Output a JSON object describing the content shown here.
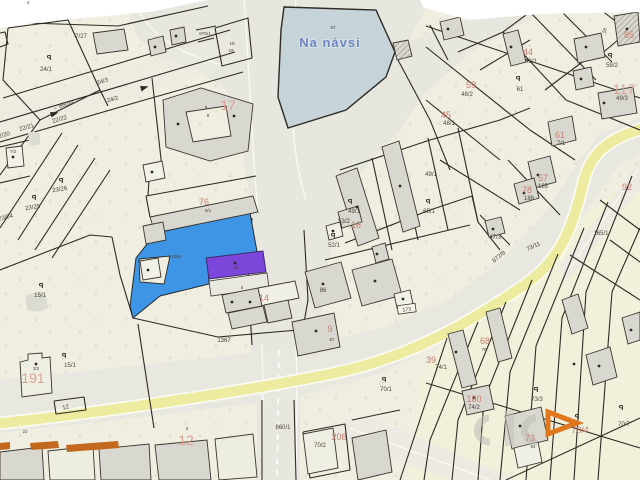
{
  "map": {
    "type": "cadastral-map",
    "pond": {
      "name": "Na návsi",
      "parcel": "67"
    },
    "highlight": {
      "selected_parcel_color": "#3e95e5",
      "selected_building_color": "#7b46d9",
      "selected_building_label": "60",
      "selected_area_ref": "1364"
    },
    "road": {
      "stripe_color": "#eceb9f",
      "plate_number": "173"
    },
    "watermark": {
      "arrow_color": "#e0761e"
    },
    "labels": [
      {
        "text": "Na návsi",
        "x": 330,
        "y": 47,
        "cls": "pond"
      },
      {
        "text": "67",
        "x": 333,
        "y": 29,
        "cls": "pt"
      },
      {
        "text": "875/1",
        "x": 205,
        "y": 35,
        "cls": "pt"
      },
      {
        "text": "18",
        "x": 232,
        "y": 45,
        "cls": "pt"
      },
      {
        "text": "19",
        "x": 231,
        "y": 52,
        "cls": "pt"
      },
      {
        "text": "7/27",
        "x": 81,
        "y": 38,
        "cls": "p"
      },
      {
        "text": "4",
        "x": 28,
        "y": 4,
        "cls": "pt"
      },
      {
        "text": "24/1",
        "x": 46,
        "y": 71,
        "cls": "p"
      },
      {
        "text": "24/3",
        "x": 103,
        "y": 83,
        "cls": "p",
        "rot": -18
      },
      {
        "text": "→ 860/4",
        "x": 63,
        "y": 107,
        "cls": "p",
        "rot": -17
      },
      {
        "text": "22/22",
        "x": 60,
        "y": 121,
        "cls": "p",
        "rot": -15
      },
      {
        "text": "22/21",
        "x": 27,
        "y": 129,
        "cls": "p",
        "rot": -15
      },
      {
        "text": "22/20",
        "x": 3,
        "y": 137,
        "cls": "p",
        "rot": -15
      },
      {
        "text": "24/2",
        "x": 113,
        "y": 101,
        "cls": "p",
        "rot": -15
      },
      {
        "text": "7/2",
        "x": 13,
        "y": 153,
        "cls": "pt"
      },
      {
        "text": "9",
        "x": 206,
        "y": 109,
        "cls": "pt"
      },
      {
        "text": "8",
        "x": 208,
        "y": 117,
        "cls": "pt"
      },
      {
        "text": "17",
        "x": 228,
        "y": 110,
        "cls": "hl"
      },
      {
        "text": "23/26",
        "x": 60,
        "y": 191,
        "cls": "p",
        "rot": -10
      },
      {
        "text": "23/25",
        "x": 33,
        "y": 209,
        "cls": "p",
        "rot": -10
      },
      {
        "text": "23/24",
        "x": 6,
        "y": 219,
        "cls": "p",
        "rot": -14
      },
      {
        "text": "15/1",
        "x": 40,
        "y": 297,
        "cls": "p"
      },
      {
        "text": "15/1",
        "x": 70,
        "y": 367,
        "cls": "p"
      },
      {
        "text": "3/2",
        "x": 36,
        "y": 370,
        "cls": "pt"
      },
      {
        "text": "191",
        "x": 33,
        "y": 383,
        "cls": "hl",
        "size": 15
      },
      {
        "text": "12",
        "x": 66,
        "y": 409,
        "cls": "p",
        "rot": -12
      },
      {
        "text": "22",
        "x": 25,
        "y": 433,
        "cls": "pt"
      },
      {
        "text": "2",
        "x": 187,
        "y": 430,
        "cls": "pt"
      },
      {
        "text": "12",
        "x": 186,
        "y": 445,
        "cls": "hl"
      },
      {
        "text": "76",
        "x": 204,
        "y": 205,
        "cls": "h",
        "size": 8
      },
      {
        "text": "6/1",
        "x": 208,
        "y": 212,
        "cls": "pt"
      },
      {
        "text": "←1364",
        "x": 174,
        "y": 258,
        "cls": "pt"
      },
      {
        "text": "60",
        "x": 236,
        "y": 269,
        "cls": "pt"
      },
      {
        "text": "5",
        "x": 242,
        "y": 289,
        "cls": "pt"
      },
      {
        "text": "14",
        "x": 264,
        "y": 301,
        "cls": "h",
        "size": 10
      },
      {
        "text": "1367",
        "x": 224,
        "y": 342,
        "cls": "p"
      },
      {
        "text": "86",
        "x": 323,
        "y": 292,
        "cls": "p"
      },
      {
        "text": "9",
        "x": 330,
        "y": 332,
        "cls": "h"
      },
      {
        "text": "87",
        "x": 332,
        "y": 341,
        "cls": "pt"
      },
      {
        "text": "860/1",
        "x": 283,
        "y": 429,
        "cls": "p"
      },
      {
        "text": "70/2",
        "x": 320,
        "y": 447,
        "cls": "p"
      },
      {
        "text": "208",
        "x": 339,
        "y": 440,
        "cls": "h",
        "size": 10
      },
      {
        "text": "70/1",
        "x": 386,
        "y": 391,
        "cls": "p"
      },
      {
        "text": "173",
        "x": 407,
        "y": 311,
        "cls": "plate",
        "rot": -8,
        "plate": true
      },
      {
        "text": "44",
        "x": 528,
        "y": 55,
        "cls": "h",
        "size": 8
      },
      {
        "text": "43/1",
        "x": 531,
        "y": 63,
        "cls": "p"
      },
      {
        "text": "59",
        "x": 471,
        "y": 88,
        "cls": "h"
      },
      {
        "text": "48/2",
        "x": 467,
        "y": 96,
        "cls": "p"
      },
      {
        "text": "45",
        "x": 446,
        "y": 118,
        "cls": "h"
      },
      {
        "text": "48/1",
        "x": 449,
        "y": 125,
        "cls": "p"
      },
      {
        "text": "61",
        "x": 520,
        "y": 91,
        "cls": "p"
      },
      {
        "text": "58",
        "x": 606,
        "y": 31,
        "cls": "pt",
        "rot": -70
      },
      {
        "text": "85",
        "x": 629,
        "y": 38,
        "cls": "h"
      },
      {
        "text": "58/2",
        "x": 612,
        "y": 67,
        "cls": "p"
      },
      {
        "text": "117",
        "x": 624,
        "y": 94,
        "cls": "hl",
        "size": 13
      },
      {
        "text": "49/3",
        "x": 622,
        "y": 100,
        "cls": "p"
      },
      {
        "text": "61",
        "x": 560,
        "y": 138,
        "cls": "h"
      },
      {
        "text": "7/1",
        "x": 561,
        "y": 145,
        "cls": "p"
      },
      {
        "text": "49/1",
        "x": 431,
        "y": 176,
        "cls": "p"
      },
      {
        "text": "49/1",
        "x": 354,
        "y": 213,
        "cls": "p"
      },
      {
        "text": "53/2",
        "x": 344,
        "y": 223,
        "cls": "p"
      },
      {
        "text": "16",
        "x": 356,
        "y": 228,
        "cls": "h",
        "size": 8
      },
      {
        "text": "52/1",
        "x": 334,
        "y": 247,
        "cls": "p"
      },
      {
        "text": "65/1",
        "x": 429,
        "y": 213,
        "cls": "p"
      },
      {
        "text": "57",
        "x": 543,
        "y": 181,
        "cls": "h",
        "size": 8
      },
      {
        "text": "185",
        "x": 543,
        "y": 188,
        "cls": "p"
      },
      {
        "text": "78",
        "x": 527,
        "y": 193,
        "cls": "h",
        "size": 8
      },
      {
        "text": "188",
        "x": 529,
        "y": 200,
        "cls": "p"
      },
      {
        "text": "92",
        "x": 627,
        "y": 190,
        "cls": "h"
      },
      {
        "text": "47/3",
        "x": 495,
        "y": 239,
        "cls": "p"
      },
      {
        "text": "73/11",
        "x": 534,
        "y": 248,
        "cls": "p",
        "rot": -25
      },
      {
        "text": "872/8",
        "x": 500,
        "y": 258,
        "cls": "p",
        "rot": -40
      },
      {
        "text": "165/1",
        "x": 601,
        "y": 235,
        "cls": "p"
      },
      {
        "text": "68",
        "x": 485,
        "y": 344,
        "cls": "h",
        "size": 11
      },
      {
        "text": "76",
        "x": 484,
        "y": 351,
        "cls": "pt"
      },
      {
        "text": "39",
        "x": 431,
        "y": 363,
        "cls": "h"
      },
      {
        "text": "74/1",
        "x": 441,
        "y": 369,
        "cls": "p"
      },
      {
        "text": "180",
        "x": 474,
        "y": 402,
        "cls": "h"
      },
      {
        "text": "74/2",
        "x": 474,
        "y": 409,
        "cls": "p"
      },
      {
        "text": "73/3",
        "x": 537,
        "y": 401,
        "cls": "p"
      },
      {
        "text": "70/4",
        "x": 580,
        "y": 433,
        "cls": "h",
        "size": 7
      },
      {
        "text": "70/7",
        "x": 624,
        "y": 426,
        "cls": "p"
      },
      {
        "text": "73",
        "x": 530,
        "y": 441,
        "cls": "h"
      },
      {
        "text": "84",
        "x": 533,
        "y": 448,
        "cls": "pt"
      }
    ],
    "p_markers": [
      [
        49,
        60
      ],
      [
        61,
        183
      ],
      [
        34,
        200
      ],
      [
        41,
        288
      ],
      [
        64,
        358
      ],
      [
        350,
        204
      ],
      [
        333,
        238
      ],
      [
        428,
        204
      ],
      [
        518,
        81
      ],
      [
        610,
        58
      ],
      [
        384,
        382
      ],
      [
        536,
        392
      ],
      [
        577,
        419
      ],
      [
        621,
        410
      ]
    ],
    "dots": [
      [
        13,
        157
      ],
      [
        155,
        47
      ],
      [
        176,
        36
      ],
      [
        152,
        172
      ],
      [
        178,
        124
      ],
      [
        234,
        116
      ],
      [
        448,
        29
      ],
      [
        511,
        47
      ],
      [
        586,
        47
      ],
      [
        627,
        29
      ],
      [
        604,
        103
      ],
      [
        581,
        79
      ],
      [
        538,
        175
      ],
      [
        524,
        193
      ],
      [
        493,
        229
      ],
      [
        333,
        231
      ],
      [
        357,
        207
      ],
      [
        400,
        186
      ],
      [
        377,
        254
      ],
      [
        403,
        299
      ],
      [
        323,
        284
      ],
      [
        375,
        281
      ],
      [
        250,
        302
      ],
      [
        232,
        302
      ],
      [
        148,
        270
      ],
      [
        235,
        263
      ],
      [
        316,
        331
      ],
      [
        456,
        352
      ],
      [
        474,
        398
      ],
      [
        520,
        426
      ],
      [
        574,
        364
      ],
      [
        599,
        366
      ],
      [
        631,
        330
      ],
      [
        36,
        364
      ]
    ],
    "arrows": [
      {
        "x": 50,
        "y": 112,
        "rot": -17
      },
      {
        "x": 140,
        "y": 86,
        "rot": -17
      }
    ]
  }
}
